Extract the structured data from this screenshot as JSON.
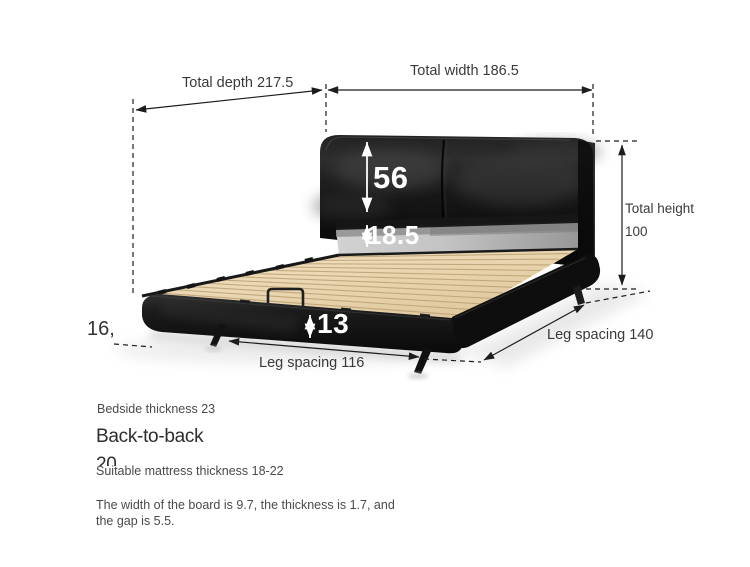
{
  "labels": {
    "total_depth": "Total depth 217.5",
    "total_width": "Total width 186.5",
    "total_height_1": "Total height",
    "total_height_2": "100",
    "headboard_height": "56",
    "backrest_height": "18.5",
    "rail_height": "13",
    "leg_spacing_front": "Leg spacing 116",
    "leg_spacing_side": "Leg spacing 140",
    "left_clipped": "16,"
  },
  "notes": {
    "bedside_thickness": "Bedside thickness 23",
    "back_to_back_label": "Back-to-back",
    "back_to_back_value": "20",
    "mattress_thickness": "Suitable mattress thickness 18-22",
    "board_spec": "The width of the board is 9.7, the thickness is 1.7, and the gap is 5.5."
  },
  "colors": {
    "background": "#ffffff",
    "dimension_line": "#1c1c1c",
    "label_text": "#3a3a3a",
    "note_text": "#4a4a4a",
    "leather": "#141414",
    "metal_band": "#bcbcbc",
    "wood_slats": "#e8d4ae",
    "measure_text_on_bed": "#ffffff"
  }
}
